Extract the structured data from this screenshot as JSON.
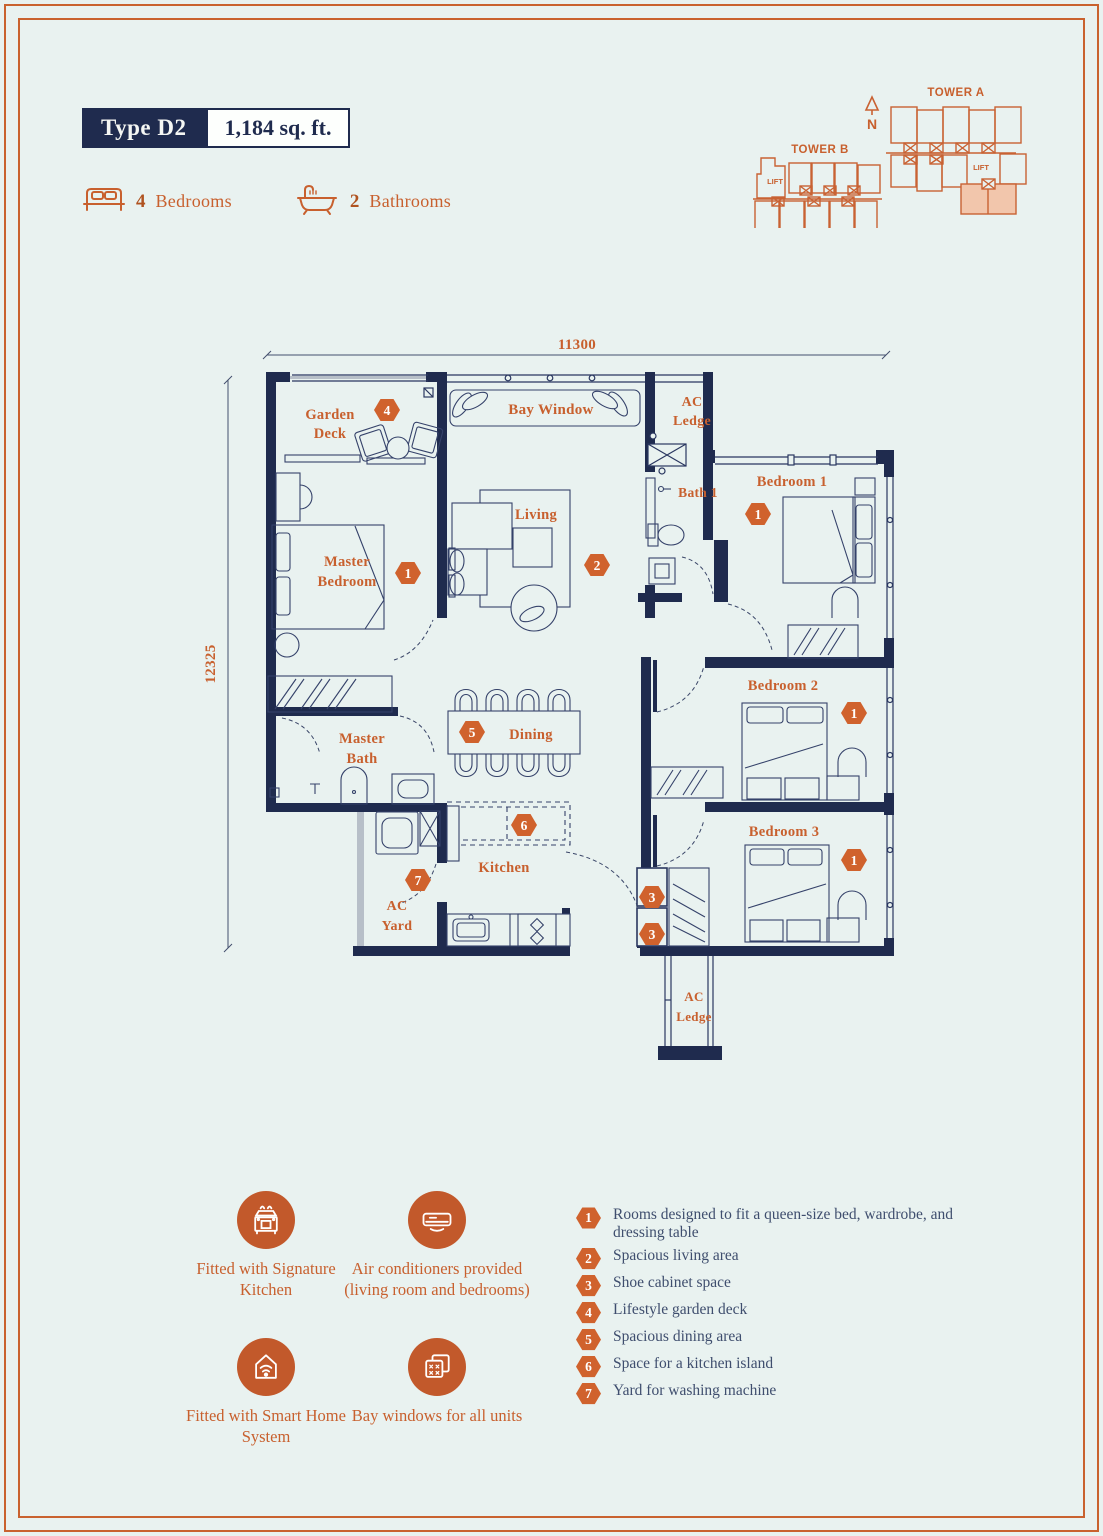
{
  "header": {
    "type_label": "Type D2",
    "area_label": "1,184 sq. ft.",
    "bedrooms_count": "4",
    "bedrooms_label": "Bedrooms",
    "bathrooms_count": "2",
    "bathrooms_label": "Bathrooms"
  },
  "keyplan": {
    "tower_a_label": "TOWER A",
    "tower_b_label": "TOWER B",
    "north_label": "N",
    "lift_label": "LIFT"
  },
  "plan": {
    "dims": {
      "top": "11300",
      "left": "12325"
    },
    "labels": {
      "garden_deck": [
        "Garden",
        "Deck"
      ],
      "bay_window": "Bay Window",
      "ac_ledge_top": [
        "AC",
        "Ledge"
      ],
      "master_bedroom": [
        "Master",
        "Bedroom"
      ],
      "living": "Living",
      "bath1": "Bath 1",
      "bedroom1": "Bedroom 1",
      "master_bath": [
        "Master",
        "Bath"
      ],
      "dining": "Dining",
      "kitchen": "Kitchen",
      "ac_yard": [
        "AC",
        "Yard"
      ],
      "bedroom2": "Bedroom 2",
      "bedroom3": "Bedroom 3",
      "ac_ledge_bottom": [
        "AC",
        "Ledge"
      ]
    },
    "markers": {
      "garden": "4",
      "master_bedroom": "1",
      "living": "2",
      "bedroom1": "1",
      "dining": "5",
      "island": "6",
      "yard": "7",
      "shoe_upper": "3",
      "shoe_lower": "3",
      "bedroom2": "1",
      "bedroom3": "1"
    }
  },
  "features": [
    {
      "icon": "kitchen-icon",
      "label": "Fitted with Signature Kitchen"
    },
    {
      "icon": "ac-icon",
      "label": "Air conditioners provided (living room and bedrooms)"
    },
    {
      "icon": "smart-home-icon",
      "label": "Fitted with Smart Home System"
    },
    {
      "icon": "bay-window-icon",
      "label": "Bay windows for all units"
    }
  ],
  "legend": [
    {
      "num": "1",
      "text": "Rooms designed to fit a queen-size bed, wardrobe, and dressing table"
    },
    {
      "num": "2",
      "text": "Spacious living area"
    },
    {
      "num": "3",
      "text": "Shoe cabinet space"
    },
    {
      "num": "4",
      "text": "Lifestyle garden deck"
    },
    {
      "num": "5",
      "text": "Spacious dining area"
    },
    {
      "num": "6",
      "text": "Space for a kitchen island"
    },
    {
      "num": "7",
      "text": "Yard for washing machine"
    }
  ],
  "colors": {
    "navy": "#1f2b4e",
    "orange": "#c8602e",
    "marker_fill": "#d0622d",
    "highlight_unit": "#f2c6ac",
    "background": "#e9f2f0"
  }
}
